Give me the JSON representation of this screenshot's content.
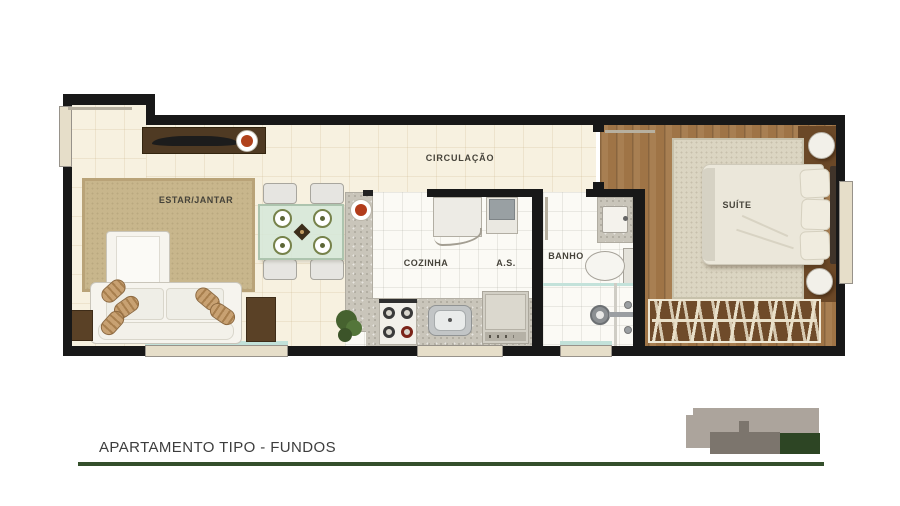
{
  "plan": {
    "rooms": {
      "living": {
        "label": "ESTAR/JANTAR"
      },
      "circulation": {
        "label": "CIRCULAÇÃO"
      },
      "kitchen": {
        "label": "COZINHA"
      },
      "service_area": {
        "label": "A.S."
      },
      "bathroom": {
        "label": "BANHO"
      },
      "suite": {
        "label": "SUÍTE"
      }
    }
  },
  "footer": {
    "plan_title": "APARTAMENTO TIPO - FUNDOS"
  },
  "colors": {
    "wall": "#181818",
    "floor_cream": "#f7f1e0",
    "floor_white": "#fbfaf5",
    "floor_wood": "#9f744e",
    "rug_living": "#c8b68c",
    "rug_suite": "#dbd5c2",
    "granite": "#c9c5ba",
    "window_beige": "#e6dec9",
    "glass_teal": "#c2e1d9",
    "accent_green": "#344f2b",
    "logo_light_gray": "#aca49c",
    "logo_dark_gray": "#7c756d",
    "logo_green": "#2d4524",
    "title_gray": "#3d3d3d"
  }
}
